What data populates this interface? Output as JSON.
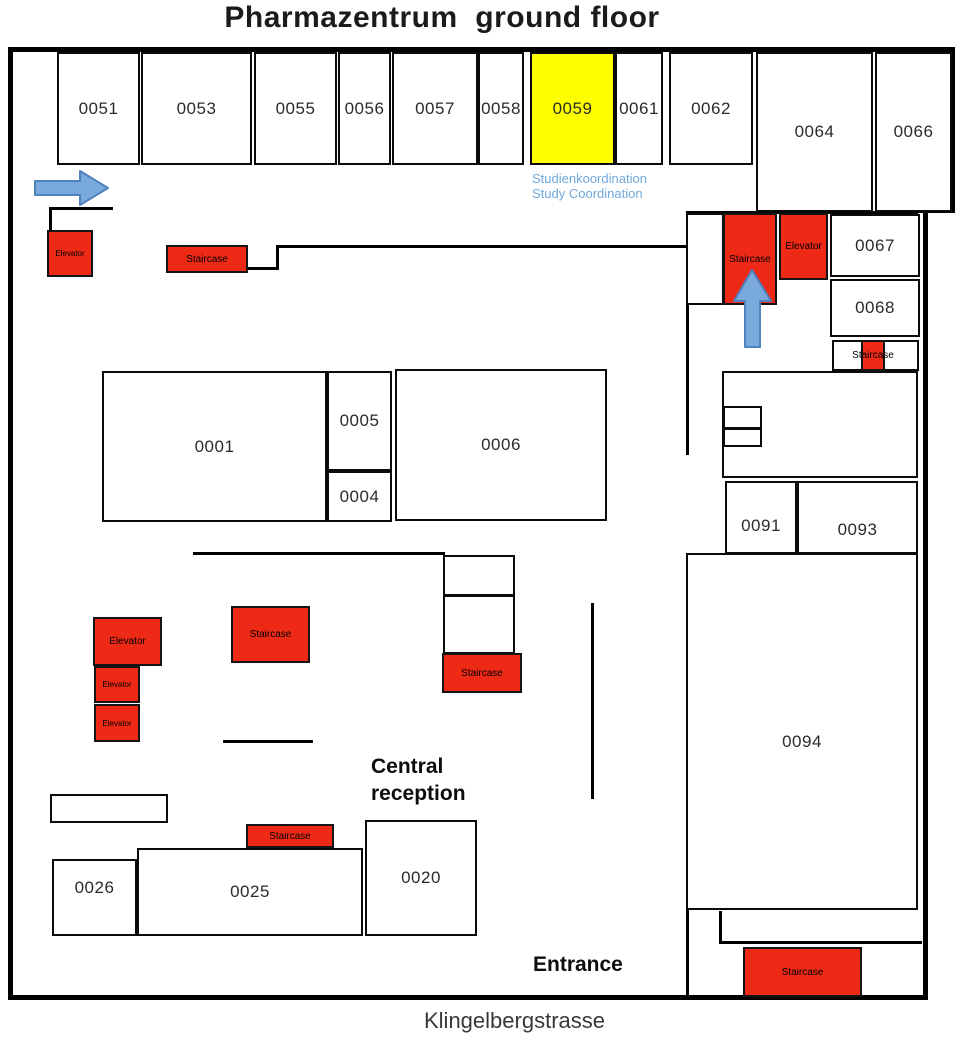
{
  "title": "Pharmazentrum  ground floor",
  "street_label": "Klingelbergstrasse",
  "annotations": {
    "study_coordination": "Studienkoordination\nStudy Coordination",
    "central_reception": "Central\nreception",
    "entrance": "Entrance"
  },
  "colors": {
    "wall": "#000000",
    "room_fill": "#ffffff",
    "highlight_fill": "#ffff00",
    "facility_fill": "#ee2a17",
    "arrow_fill": "#7aa9dc",
    "arrow_stroke": "#4f81bd",
    "info_text": "#6fa8dc"
  },
  "rooms": [
    {
      "id": "0051",
      "label": "0051",
      "x": 57,
      "y": 52,
      "w": 83,
      "h": 113
    },
    {
      "id": "0053",
      "label": "0053",
      "x": 141,
      "y": 52,
      "w": 111,
      "h": 113
    },
    {
      "id": "0055",
      "label": "0055",
      "x": 254,
      "y": 52,
      "w": 83,
      "h": 113
    },
    {
      "id": "0056",
      "label": "0056",
      "x": 338,
      "y": 52,
      "w": 53,
      "h": 113
    },
    {
      "id": "0057",
      "label": "0057",
      "x": 392,
      "y": 52,
      "w": 86,
      "h": 113
    },
    {
      "id": "0058",
      "label": "0058",
      "x": 478,
      "y": 52,
      "w": 46,
      "h": 113
    },
    {
      "id": "0059",
      "label": "0059",
      "x": 530,
      "y": 52,
      "w": 85,
      "h": 113,
      "fill": "#ffff00"
    },
    {
      "id": "0061",
      "label": "0061",
      "x": 615,
      "y": 52,
      "w": 48,
      "h": 113
    },
    {
      "id": "0062",
      "label": "0062",
      "x": 669,
      "y": 52,
      "w": 84,
      "h": 113
    },
    {
      "id": "0064",
      "label": "0064",
      "x": 756,
      "y": 52,
      "w": 117,
      "h": 160
    },
    {
      "id": "0066",
      "label": "0066",
      "x": 875,
      "y": 52,
      "w": 77,
      "h": 160
    },
    {
      "id": "0067",
      "label": "0067",
      "x": 830,
      "y": 214,
      "w": 90,
      "h": 63
    },
    {
      "id": "0068",
      "label": "0068",
      "x": 830,
      "y": 279,
      "w": 90,
      "h": 58
    },
    {
      "id": "0001",
      "label": "0001",
      "x": 102,
      "y": 371,
      "w": 225,
      "h": 151
    },
    {
      "id": "0005",
      "label": "0005",
      "x": 327,
      "y": 371,
      "w": 65,
      "h": 100
    },
    {
      "id": "0004",
      "label": "0004",
      "x": 327,
      "y": 471,
      "w": 65,
      "h": 51
    },
    {
      "id": "0006",
      "label": "0006",
      "x": 395,
      "y": 369,
      "w": 212,
      "h": 152
    },
    {
      "id": "0091",
      "label": "0091",
      "x": 725,
      "y": 481,
      "w": 72,
      "h": 73,
      "ldy": 8
    },
    {
      "id": "0093",
      "label": "0093",
      "x": 797,
      "y": 481,
      "w": 121,
      "h": 73,
      "ldy": 12
    },
    {
      "id": "0094",
      "label": "0094",
      "x": 686,
      "y": 553,
      "w": 232,
      "h": 357,
      "ldy": 10
    },
    {
      "id": "0026",
      "label": "0026",
      "x": 52,
      "y": 859,
      "w": 85,
      "h": 77,
      "ldy": -10
    },
    {
      "id": "0025",
      "label": "0025",
      "x": 137,
      "y": 848,
      "w": 226,
      "h": 88
    },
    {
      "id": "0020",
      "label": "0020",
      "x": 365,
      "y": 820,
      "w": 112,
      "h": 116
    }
  ],
  "boxes": [
    {
      "x": 686,
      "y": 213,
      "w": 38,
      "h": 92
    },
    {
      "x": 832,
      "y": 340,
      "w": 87,
      "h": 31
    },
    {
      "x": 722,
      "y": 371,
      "w": 196,
      "h": 107
    },
    {
      "x": 723,
      "y": 406,
      "w": 39,
      "h": 23
    },
    {
      "x": 723,
      "y": 428,
      "w": 39,
      "h": 19
    },
    {
      "x": 831,
      "y": 481,
      "w": 72,
      "h": 33
    },
    {
      "x": 443,
      "y": 555,
      "w": 72,
      "h": 41
    },
    {
      "x": 443,
      "y": 595,
      "w": 72,
      "h": 59
    },
    {
      "x": 50,
      "y": 794,
      "w": 118,
      "h": 29
    }
  ],
  "walls": [
    {
      "x": 8,
      "y": 47,
      "w": 947,
      "h": 5
    },
    {
      "x": 8,
      "y": 47,
      "w": 5,
      "h": 953
    },
    {
      "x": 8,
      "y": 995,
      "w": 920,
      "h": 5
    },
    {
      "x": 950,
      "y": 47,
      "w": 5,
      "h": 166
    },
    {
      "x": 918,
      "y": 208,
      "w": 37,
      "h": 5
    },
    {
      "x": 923,
      "y": 208,
      "w": 5,
      "h": 792
    },
    {
      "x": 49,
      "y": 207,
      "w": 64,
      "h": 3
    },
    {
      "x": 49,
      "y": 207,
      "w": 3,
      "h": 26
    },
    {
      "x": 248,
      "y": 267,
      "w": 31,
      "h": 3
    },
    {
      "x": 276,
      "y": 245,
      "w": 3,
      "h": 25
    },
    {
      "x": 276,
      "y": 245,
      "w": 412,
      "h": 3
    },
    {
      "x": 686,
      "y": 211,
      "w": 232,
      "h": 3
    },
    {
      "x": 686,
      "y": 211,
      "w": 3,
      "h": 244
    },
    {
      "x": 686,
      "y": 908,
      "w": 3,
      "h": 90
    },
    {
      "x": 719,
      "y": 911,
      "w": 3,
      "h": 33
    },
    {
      "x": 719,
      "y": 941,
      "w": 203,
      "h": 3
    },
    {
      "x": 722,
      "y": 422,
      "w": 196,
      "h": 2
    },
    {
      "x": 722,
      "y": 428,
      "w": 196,
      "h": 2
    },
    {
      "x": 193,
      "y": 552,
      "w": 252,
      "h": 3
    },
    {
      "x": 591,
      "y": 603,
      "w": 3,
      "h": 196
    },
    {
      "x": 223,
      "y": 740,
      "w": 90,
      "h": 3
    }
  ],
  "facilities": [
    {
      "type": "elevator",
      "label": "Elevator",
      "x": 47,
      "y": 230,
      "w": 46,
      "h": 47,
      "fs": 8
    },
    {
      "type": "staircase",
      "label": "Staircase",
      "x": 166,
      "y": 245,
      "w": 82,
      "h": 28,
      "fs": 10
    },
    {
      "type": "staircase",
      "label": "Staircase",
      "x": 723,
      "y": 213,
      "w": 54,
      "h": 92,
      "fs": 10
    },
    {
      "type": "elevator",
      "label": "Elevator",
      "x": 779,
      "y": 213,
      "w": 49,
      "h": 67,
      "fs": 10
    },
    {
      "type": "staircase",
      "label": "Staircase",
      "x": 861,
      "y": 340,
      "w": 24,
      "h": 31,
      "fs": 10,
      "overflow": true
    },
    {
      "type": "elevator",
      "label": "Elevator",
      "x": 93,
      "y": 617,
      "w": 69,
      "h": 49,
      "fs": 10
    },
    {
      "type": "elevator",
      "label": "Elevator",
      "x": 94,
      "y": 666,
      "w": 46,
      "h": 37,
      "fs": 8
    },
    {
      "type": "elevator",
      "label": "Elevator",
      "x": 94,
      "y": 704,
      "w": 46,
      "h": 38,
      "fs": 8
    },
    {
      "type": "staircase",
      "label": "Staircase",
      "x": 231,
      "y": 606,
      "w": 79,
      "h": 57,
      "fs": 10
    },
    {
      "type": "staircase",
      "label": "Staircase",
      "x": 442,
      "y": 653,
      "w": 80,
      "h": 40,
      "fs": 10
    },
    {
      "type": "staircase",
      "label": "Staircase",
      "x": 246,
      "y": 824,
      "w": 88,
      "h": 24,
      "fs": 10
    },
    {
      "type": "staircase",
      "label": "Staircase",
      "x": 743,
      "y": 947,
      "w": 119,
      "h": 50,
      "fs": 10
    }
  ],
  "arrows": [
    {
      "name": "blue-arrow-right",
      "x": 35,
      "y": 169,
      "w": 75,
      "h": 38,
      "points": "0,12 45,12 45,2 73,19 45,36 45,26 0,26"
    },
    {
      "name": "blue-arrow-up",
      "x": 734,
      "y": 270,
      "w": 37,
      "h": 77,
      "points": "18,0 37,31 26,31 26,77 11,77 11,31 0,31"
    }
  ]
}
